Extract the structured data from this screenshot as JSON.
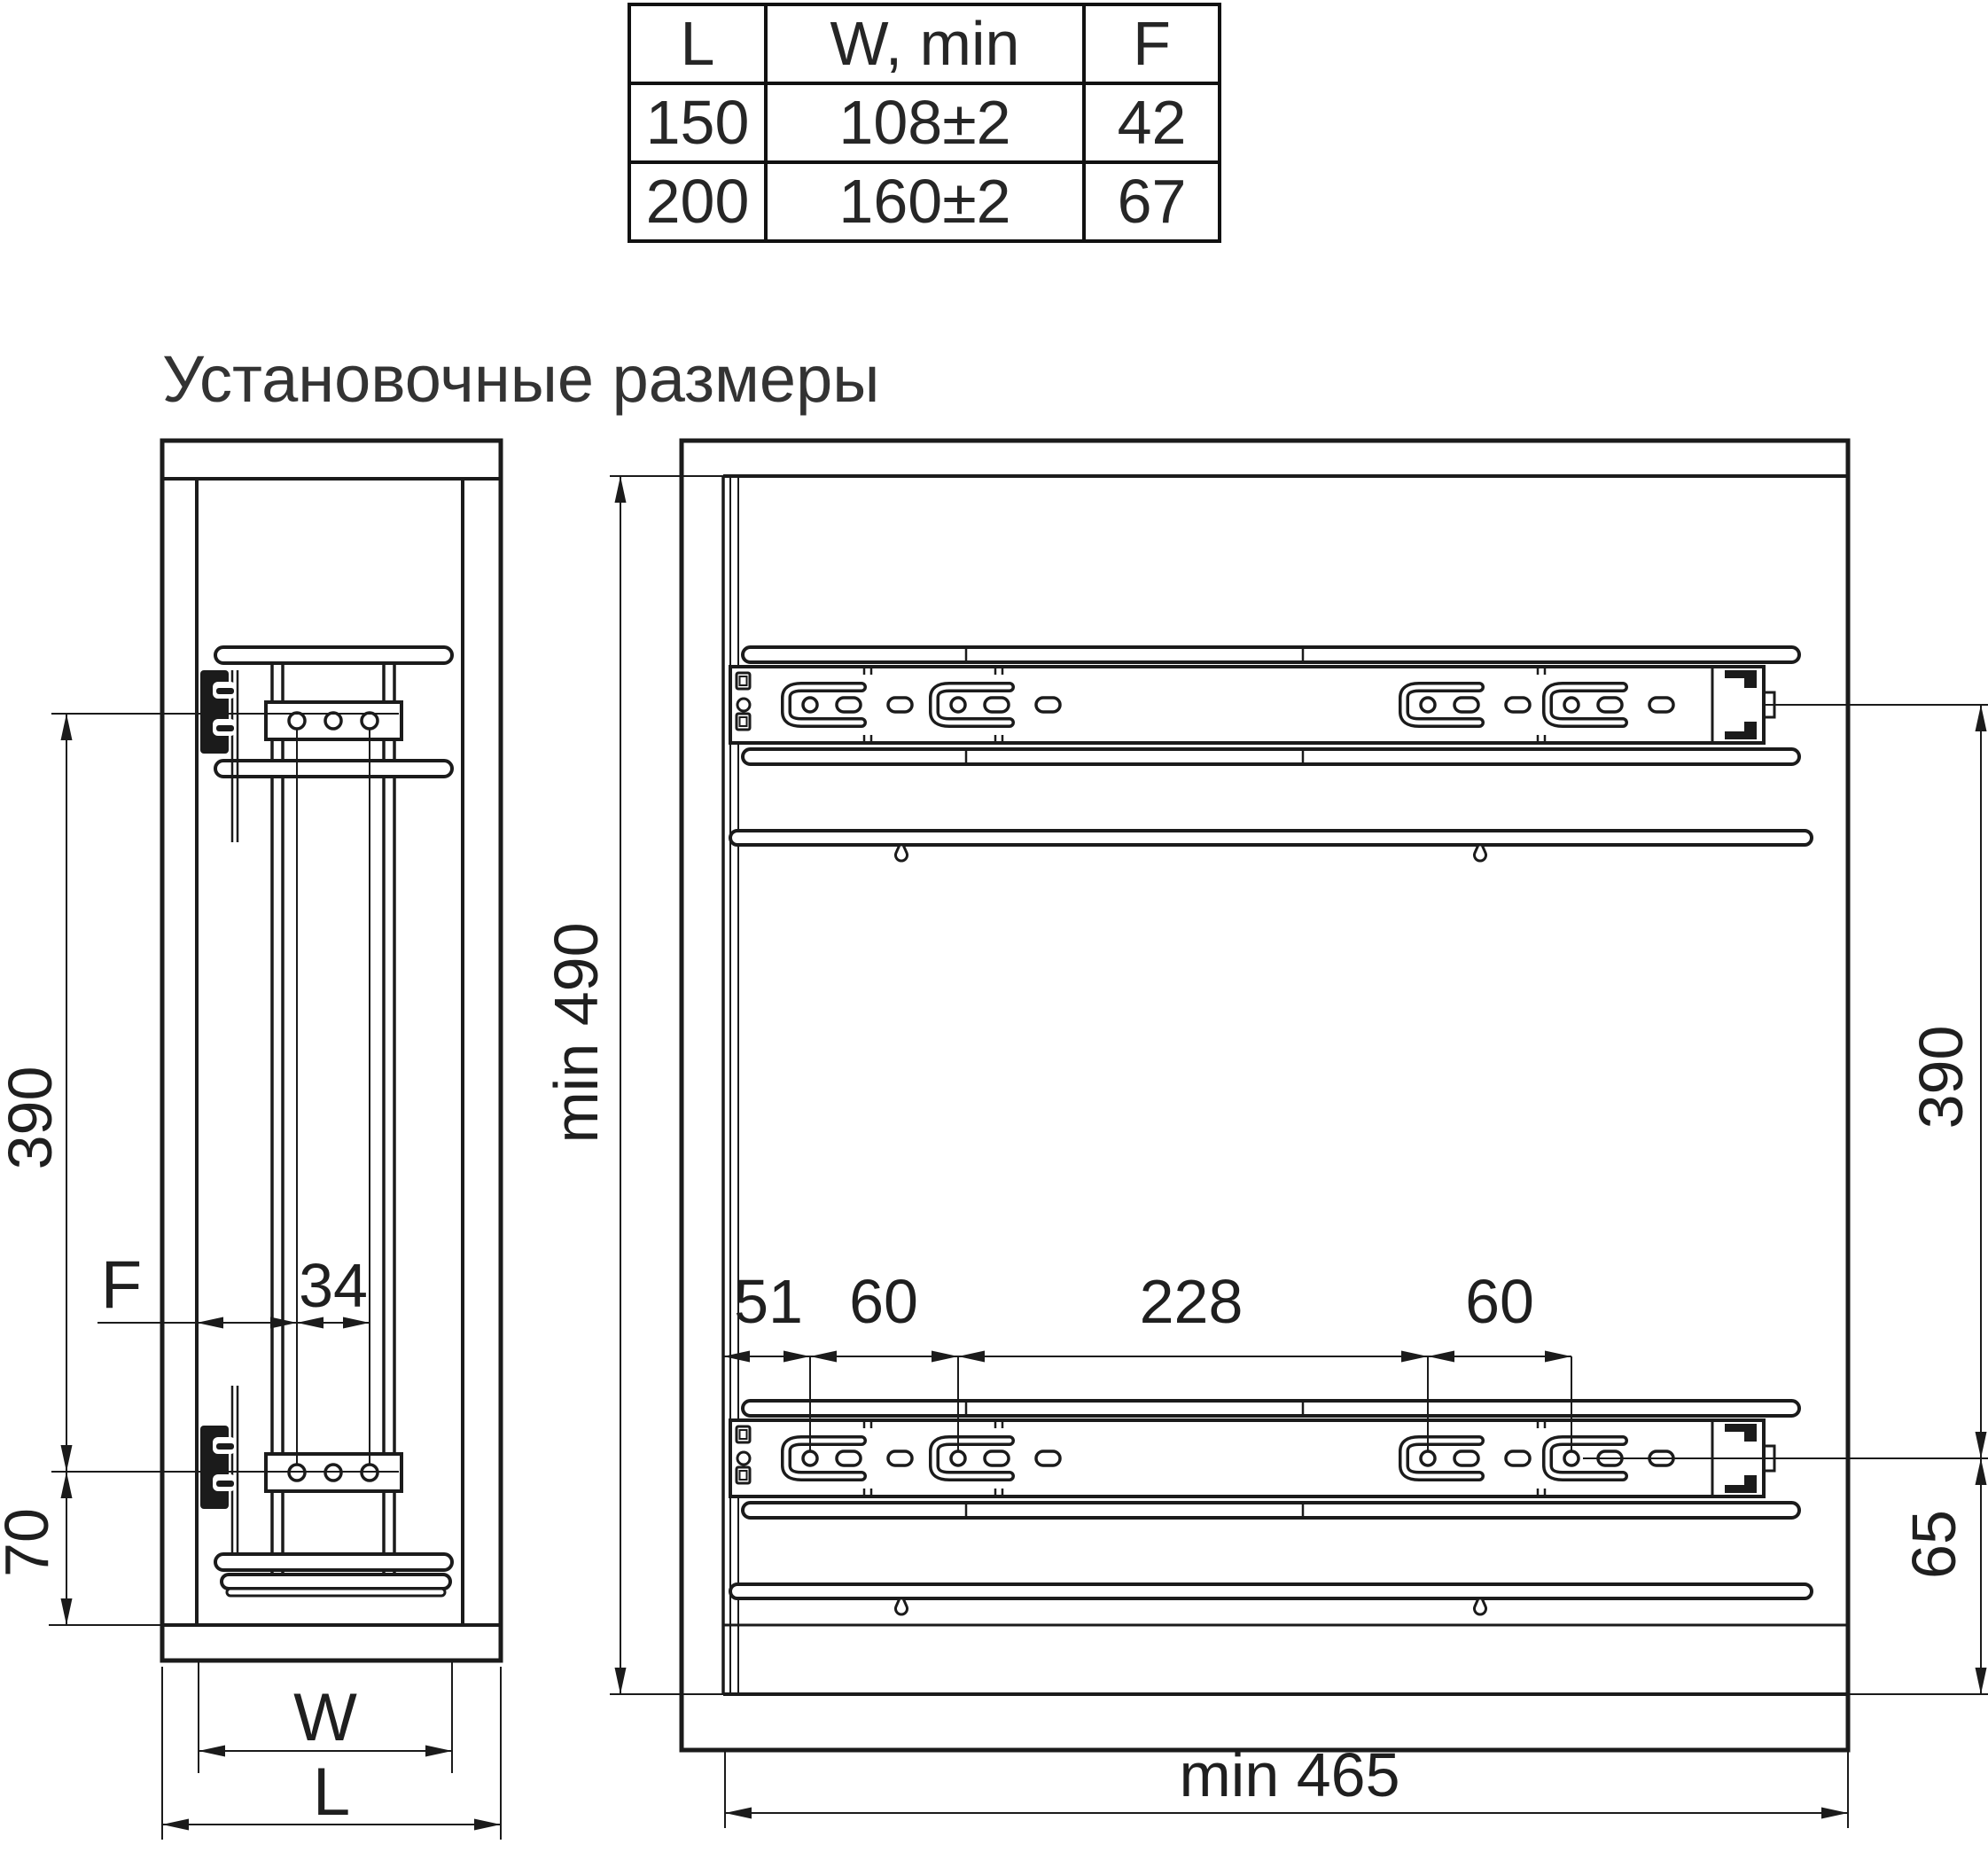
{
  "title": "Установочные размеры",
  "colors": {
    "line": "#1b1b1b",
    "text": "#222222",
    "background": "#ffffff"
  },
  "table": {
    "headers": [
      "L",
      "W, min",
      "F"
    ],
    "rows": [
      [
        "150",
        "108±2",
        "42"
      ],
      [
        "200",
        "160±2",
        "67"
      ]
    ]
  },
  "front_view": {
    "dims": {
      "height_390": "390",
      "bottom_70": "70",
      "front_gap_f": "F",
      "hole_spacing_34": "34",
      "width_w": "W",
      "length_l": "L"
    }
  },
  "side_view": {
    "dims": {
      "min_depth_490": "min 490",
      "slide_spacing_390": "390",
      "front_offset_51": "51",
      "hole_pitch_60_front": "60",
      "hole_pitch_228": "228",
      "hole_pitch_60_rear": "60",
      "bottom_offset_65": "65",
      "min_width_465": "min 465"
    }
  }
}
